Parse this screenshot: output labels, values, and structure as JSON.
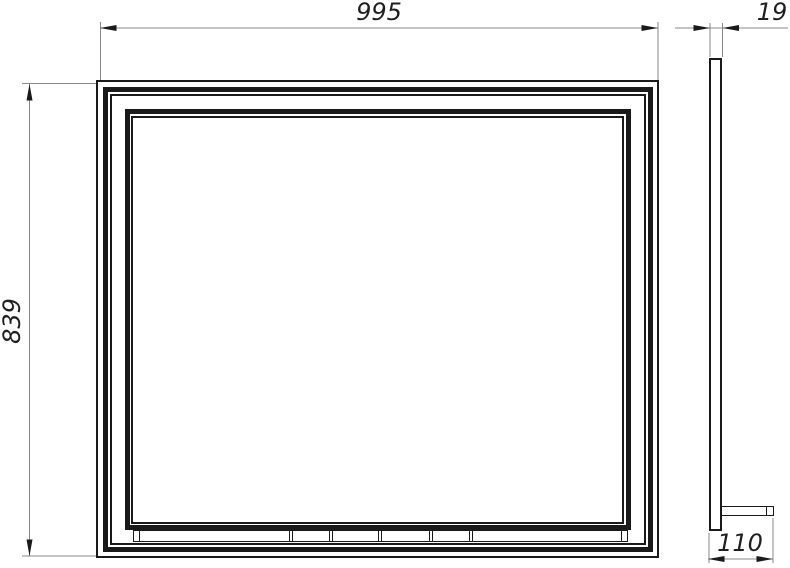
{
  "dimensions": {
    "width": "995",
    "height": "839",
    "depth": "19",
    "shelf_depth": "110"
  },
  "watermark": {
    "line1": "САНТЕХНИКА",
    "line2": "ОНЛАЙН"
  },
  "colors": {
    "line": "#1a1a1a",
    "dim_line": "#888888",
    "dim_text": "#1f1f1f",
    "watermark": "#f2f2f2",
    "background": "#ffffff"
  }
}
